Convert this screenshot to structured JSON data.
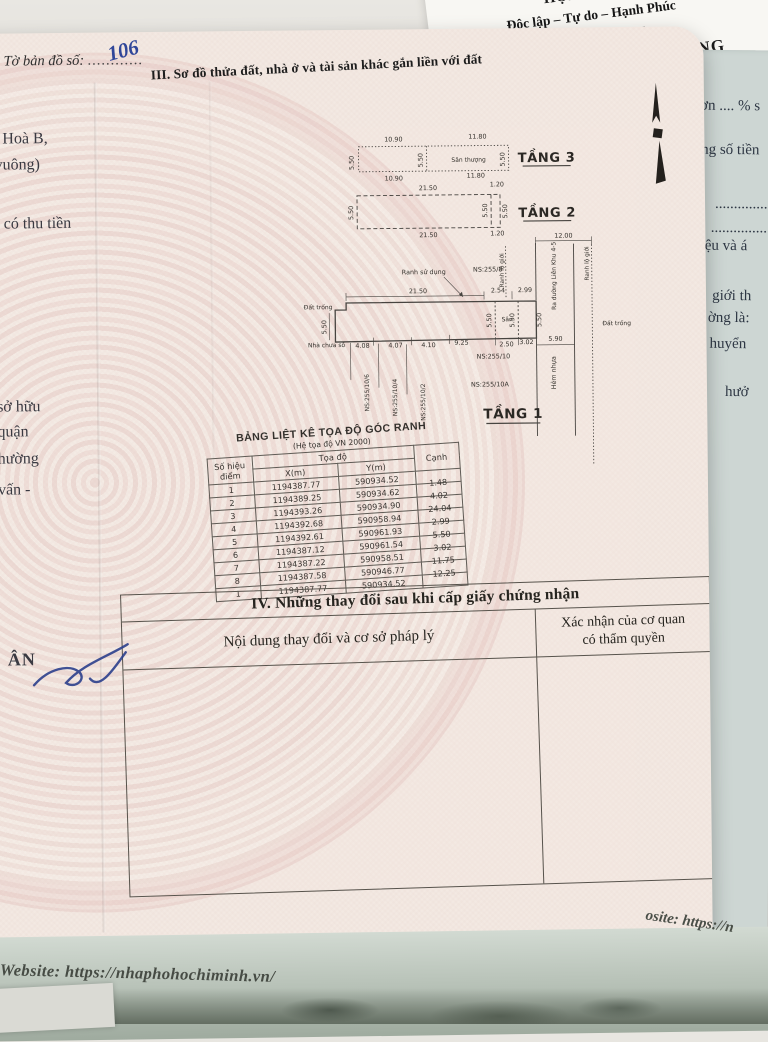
{
  "top_paper": {
    "line1": "HỘI CHỦ NG",
    "line2": "Độc lập – Tự do – Hạnh Phúc",
    "divider": "-------------o0o-------------",
    "fragment": "ƯỞNG"
  },
  "right_paper": {
    "fragments": [
      "ơn .... % s",
      "ổng số tiền",
      "..................",
      "..................",
      "iệu và á",
      "giới th",
      "ờng là:",
      "huyển",
      "hưở"
    ]
  },
  "left_page": {
    "map_sheet_label": "Tờ bản đồ số:",
    "map_sheet_dots": "............",
    "map_sheet_value": "106",
    "fragments": [
      "Hoà B,",
      "vuông)",
      "t có thu tiền",
      "sở hữu",
      "quận",
      "hường",
      "vấn -",
      "ÂN"
    ]
  },
  "section3": {
    "title": "III. Sơ đồ thửa đất, nhà ở và tài sản khác gắn liền với đất"
  },
  "floor3": {
    "name": "TẦNG 3",
    "room": "Sân thượng",
    "d10_90": "10.90",
    "d11_80": "11.80",
    "d5_50": "5.50"
  },
  "floor2": {
    "name": "TẦNG 2",
    "d21_50": "21.50",
    "d1_20": "1.20",
    "d5_50": "5.50"
  },
  "floor1": {
    "name": "TẦNG 1",
    "ranh_su_dung": "Ranh sử dụng",
    "ns_255_8": "NS:255/8",
    "ns_255_10": "NS:255/10",
    "ns_255_10a": "NS:255/10A",
    "ns_255_10_6": "NS:255/10/6",
    "ns_255_10_4": "NS:255/10/4",
    "ns_255_10_2": "NS:255/10/2",
    "dat_trong_left": "Đất trống",
    "dat_trong_right": "Đất trống",
    "nha_chua_so": "Nhà chưa số",
    "san": "Sân",
    "hem_nhua": "Hẻm nhựa",
    "ra_duong": "Ra đường Liên Khu 4-5",
    "ranh_lo_gioi": "Ranh lộ giới",
    "d21_50": "21.50",
    "d2_54": "2.54",
    "d2_99": "2.99",
    "d12_00": "12.00",
    "d5_50": "5.50",
    "d5_90": "5.90",
    "d4_08": "4.08",
    "d4_07": "4.07",
    "d4_10": "4.10",
    "d9_25": "9.25",
    "d2_50": "2.50",
    "d3_02": "3.02"
  },
  "coord_table": {
    "title": "BẢNG LIỆT KÊ TỌA ĐỘ GÓC RANH",
    "subtitle": "(Hệ tọa độ VN 2000)",
    "col_point_line1": "Số hiệu",
    "col_point_line2": "điểm",
    "col_coord": "Tọa độ",
    "col_x": "X(m)",
    "col_y": "Y(m)",
    "col_edge": "Cạnh",
    "rows": [
      {
        "p": "1",
        "x": "1194387.77",
        "y": "590934.52",
        "c": "1.48"
      },
      {
        "p": "2",
        "x": "1194389.25",
        "y": "590934.62",
        "c": "4.02"
      },
      {
        "p": "3",
        "x": "1194393.26",
        "y": "590934.90",
        "c": "24.04"
      },
      {
        "p": "4",
        "x": "1194392.68",
        "y": "590958.94",
        "c": "2.99"
      },
      {
        "p": "5",
        "x": "1194392.61",
        "y": "590961.93",
        "c": "5.50"
      },
      {
        "p": "6",
        "x": "1194387.12",
        "y": "590961.54",
        "c": "3.02"
      },
      {
        "p": "7",
        "x": "1194387.22",
        "y": "590958.51",
        "c": "11.75"
      },
      {
        "p": "8",
        "x": "1194387.58",
        "y": "590946.77",
        "c": "12.25"
      },
      {
        "p": "1",
        "x": "1194387.77",
        "y": "590934.52",
        "c": ""
      }
    ]
  },
  "section4": {
    "title": "IV. Những thay đổi sau khi cấp giấy chứng nhận",
    "col_content": "Nội dung thay đổi và cơ sở pháp lý",
    "col_confirm_line1": "Xác nhận của cơ quan",
    "col_confirm_line2": "có thẩm quyền"
  },
  "sleeve": {
    "website": "Website: https://nhaphohochiminh.vn/",
    "website_fragment": "osite: https://n"
  }
}
